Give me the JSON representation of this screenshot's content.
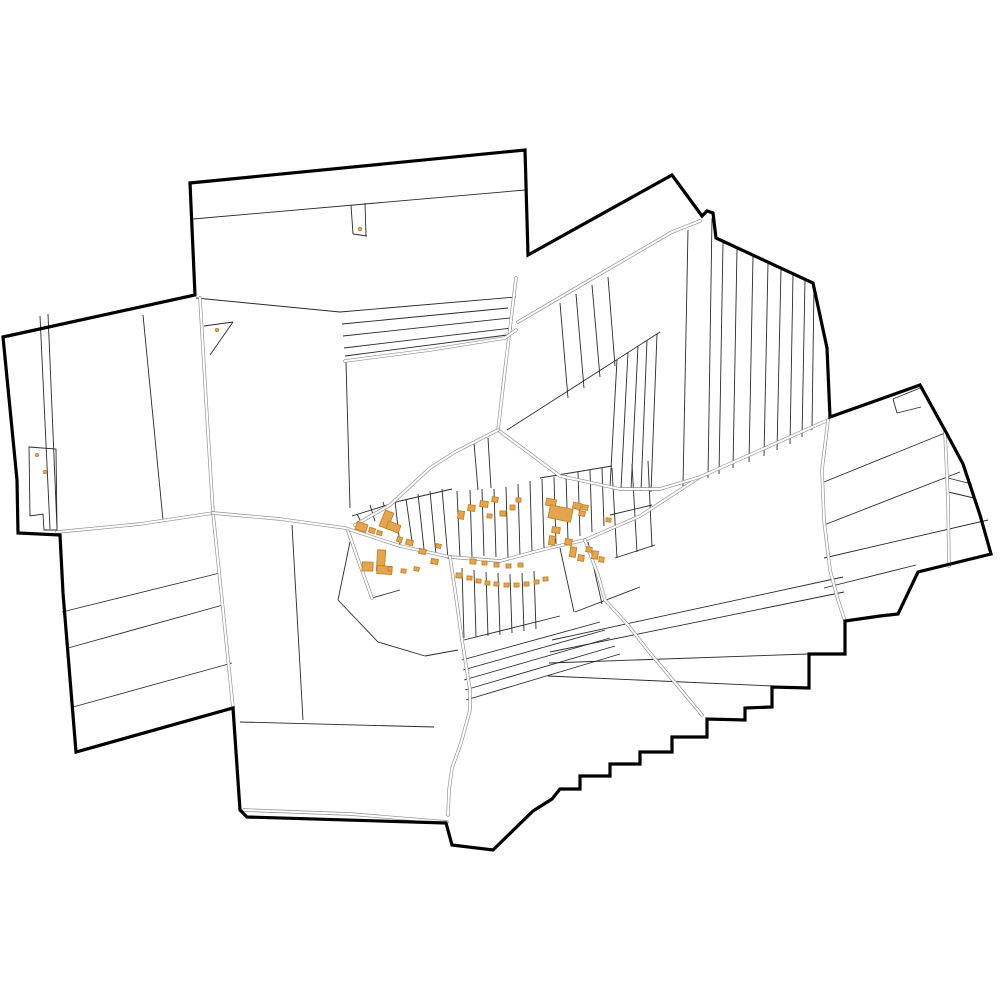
{
  "map": {
    "description": "cadastral-parcel-map-with-village",
    "background": "#ffffff",
    "colors": {
      "boundary": "#000000",
      "parcel_line": "#2a2a2a",
      "village_line": "#1f1f1f",
      "road_casing": "#8f8f8f",
      "road_fill": "#ffffff",
      "building_fill": "#e5a450",
      "building_stroke": "#c0832a",
      "dot_fill": "#dda35c",
      "dot_stroke": "#b07f35"
    },
    "stroke_widths": {
      "boundary": 3.2,
      "parcel": 0.9,
      "road_casing": 3.4,
      "road_fill": 2.1,
      "building": 0.9
    },
    "boundary_path": "M3 337 L195 295 L190 183 L525 150 L528 255 L672 175 L702 216 L707 211 L713 213 L716 238 L813 283 L827 348 L830 417 L920 385 L947 434 L963 464 L980 515 L991 554 L918 572 L898 614 L880 616 L845 621 L845 654 L809 654 L809 688 L772 687 L772 707 L745 708 L745 720 L707 719 L707 737 L672 737 L672 752 L640 752 L640 764 L610 764 L610 776 L580 776 L580 789 L560 789 L552 799 L533 811 L493 850 L452 845 L446 823 L247 817 L240 810 L233 708 L76 752 L63 593 L60 535 L18 533 L17 480 Z",
    "roads": [
      "M200 298 L206 400 L213 513",
      "M57 532 L140 524 L213 513",
      "M213 513 L222 600 L233 708",
      "M213 513 L280 519 L345 528 L400 546 L450 557 L500 561 L545 549 L585 540 L640 516 L700 477",
      "M498 430 L560 476 L620 489 L660 489 L700 477 L828 420",
      "M516 278 L505 370 L498 430",
      "M498 430 L455 452 L430 468 L390 505 L355 525",
      "M518 322 L600 274 L672 232 L700 221",
      "M345 361 L430 350 L505 338 L516 330",
      "M585 540 L598 575 L605 600 L628 625 L650 653 L677 685 L702 715",
      "M450 557 L455 590 L462 640 L470 690 L470 710 L461 743 L452 768 L449 790 L448 815",
      "M348 531 L360 565 L372 598",
      "M828 420 L822 470 L824 520 L830 570 L838 600 L845 621",
      "M945 432 L948 500 L949 566",
      "M244 810 L350 814 L447 822"
    ],
    "parcel_lines": [
      [
        193,
        219,
        525,
        190
      ],
      [
        351,
        205,
        353,
        234
      ],
      [
        353,
        234,
        367,
        236
      ],
      [
        366,
        236,
        365,
        203
      ],
      [
        196,
        298,
        340,
        312
      ],
      [
        340,
        312,
        516,
        297
      ],
      [
        342,
        324,
        508,
        308
      ],
      [
        343,
        336,
        510,
        318
      ],
      [
        344,
        348,
        512,
        328
      ],
      [
        345,
        356,
        507,
        335
      ],
      [
        40,
        316,
        50,
        529
      ],
      [
        48,
        314,
        57,
        528
      ],
      [
        143,
        315,
        163,
        520
      ],
      [
        204,
        326,
        233,
        322
      ],
      [
        233,
        322,
        210,
        355
      ],
      [
        346,
        362,
        350,
        508
      ],
      [
        292,
        525,
        303,
        720
      ],
      [
        240,
        722,
        434,
        727
      ],
      [
        62,
        612,
        220,
        573
      ],
      [
        68,
        648,
        223,
        605
      ],
      [
        73,
        707,
        232,
        663
      ],
      [
        507,
        430,
        660,
        332
      ],
      [
        560,
        303,
        568,
        398
      ],
      [
        576,
        294,
        584,
        388
      ],
      [
        592,
        285,
        600,
        377
      ],
      [
        608,
        277,
        615,
        366
      ],
      [
        617,
        360,
        610,
        487
      ],
      [
        628,
        352,
        621,
        489
      ],
      [
        638,
        346,
        631,
        490
      ],
      [
        647,
        340,
        641,
        491
      ],
      [
        657,
        334,
        651,
        492
      ],
      [
        688,
        230,
        683,
        486
      ],
      [
        712,
        218,
        708,
        478
      ],
      [
        723,
        243,
        719,
        474
      ],
      [
        737,
        249,
        733,
        468
      ],
      [
        753,
        256,
        749,
        462
      ],
      [
        768,
        263,
        764,
        456
      ],
      [
        781,
        269,
        777,
        450
      ],
      [
        793,
        275,
        790,
        444
      ],
      [
        805,
        280,
        802,
        437
      ],
      [
        814,
        285,
        812,
        430
      ],
      [
        552,
        640,
        843,
        577
      ],
      [
        550,
        652,
        844,
        592
      ],
      [
        549,
        663,
        808,
        654
      ],
      [
        548,
        676,
        772,
        686
      ],
      [
        462,
        660,
        600,
        622
      ],
      [
        463,
        670,
        605,
        630
      ],
      [
        464,
        680,
        610,
        638
      ],
      [
        465,
        690,
        615,
        646
      ],
      [
        466,
        700,
        620,
        654
      ],
      [
        824,
        525,
        960,
        472
      ],
      [
        824,
        558,
        988,
        520
      ],
      [
        824,
        588,
        916,
        565
      ],
      [
        824,
        482,
        945,
        433
      ],
      [
        948,
        478,
        972,
        484
      ],
      [
        948,
        492,
        974,
        498
      ],
      [
        893,
        399,
        920,
        388
      ],
      [
        897,
        413,
        921,
        407
      ],
      [
        893,
        399,
        897,
        413
      ],
      [
        474,
        443,
        478,
        490
      ],
      [
        488,
        438,
        491,
        488
      ],
      [
        352,
        516,
        400,
        501
      ],
      [
        400,
        501,
        452,
        489
      ],
      [
        540,
        478,
        612,
        466
      ],
      [
        362,
        524,
        357,
        514
      ],
      [
        375,
        521,
        370,
        505
      ],
      [
        388,
        519,
        383,
        502
      ],
      [
        400,
        545,
        395,
        501
      ],
      [
        412,
        541,
        406,
        499
      ],
      [
        424,
        549,
        418,
        494
      ],
      [
        436,
        555,
        430,
        491
      ],
      [
        448,
        559,
        442,
        489
      ],
      [
        460,
        558,
        457,
        491
      ],
      [
        472,
        557,
        470,
        490
      ],
      [
        484,
        556,
        482,
        489
      ],
      [
        496,
        557,
        494,
        489
      ],
      [
        508,
        558,
        506,
        487
      ],
      [
        520,
        556,
        518,
        484
      ],
      [
        532,
        552,
        530,
        481
      ],
      [
        544,
        548,
        542,
        479
      ],
      [
        556,
        544,
        554,
        477
      ],
      [
        568,
        540,
        566,
        475
      ],
      [
        580,
        536,
        578,
        472
      ],
      [
        592,
        532,
        590,
        470
      ],
      [
        604,
        526,
        602,
        468
      ],
      [
        612,
        468,
        617,
        558
      ],
      [
        632,
        464,
        637,
        552
      ],
      [
        648,
        461,
        652,
        547
      ],
      [
        610,
        515,
        652,
        505
      ],
      [
        615,
        558,
        655,
        545
      ],
      [
        462,
        568,
        464,
        638
      ],
      [
        474,
        570,
        476,
        637
      ],
      [
        486,
        572,
        488,
        636
      ],
      [
        498,
        573,
        500,
        635
      ],
      [
        510,
        574,
        512,
        633
      ],
      [
        522,
        573,
        524,
        631
      ],
      [
        534,
        571,
        536,
        629
      ],
      [
        464,
        640,
        560,
        616
      ],
      [
        560,
        548,
        574,
        612
      ],
      [
        588,
        542,
        602,
        604
      ],
      [
        575,
        612,
        640,
        587
      ],
      [
        350,
        542,
        338,
        600
      ],
      [
        338,
        600,
        378,
        642
      ],
      [
        378,
        642,
        425,
        656
      ],
      [
        425,
        656,
        458,
        650
      ],
      [
        372,
        598,
        400,
        590
      ]
    ],
    "parcel_paths": [
      "M29 447 L56 449 L57 530 L44 530 L43 514 L30 516 Z"
    ],
    "buildings": [
      [
        356,
        523,
        11,
        8,
        18
      ],
      [
        369,
        528,
        6,
        5,
        18
      ],
      [
        377,
        531,
        5,
        4,
        18
      ],
      [
        382,
        511,
        9,
        17,
        22
      ],
      [
        387,
        523,
        13,
        8,
        22
      ],
      [
        397,
        537,
        5,
        5,
        18
      ],
      [
        406,
        540,
        7,
        5,
        15
      ],
      [
        419,
        549,
        7,
        5,
        13
      ],
      [
        431,
        559,
        7,
        5,
        12
      ],
      [
        377,
        550,
        8,
        21,
        4
      ],
      [
        377,
        566,
        15,
        8,
        4
      ],
      [
        362,
        562,
        11,
        9,
        2
      ],
      [
        388,
        567,
        4,
        4,
        0
      ],
      [
        401,
        569,
        5,
        4,
        6
      ],
      [
        414,
        567,
        5,
        4,
        10
      ],
      [
        436,
        544,
        5,
        4,
        14
      ],
      [
        456,
        573,
        6,
        5,
        4
      ],
      [
        467,
        576,
        5,
        4,
        4
      ],
      [
        476,
        579,
        5,
        4,
        4
      ],
      [
        485,
        581,
        5,
        4,
        3
      ],
      [
        494,
        582,
        5,
        4,
        2
      ],
      [
        504,
        583,
        5,
        4,
        1
      ],
      [
        514,
        583,
        5,
        4,
        0
      ],
      [
        524,
        582,
        5,
        4,
        0
      ],
      [
        534,
        580,
        5,
        4,
        -2
      ],
      [
        543,
        577,
        5,
        4,
        -3
      ],
      [
        470,
        559,
        6,
        5,
        3
      ],
      [
        482,
        561,
        5,
        4,
        2
      ],
      [
        494,
        563,
        5,
        4,
        1
      ],
      [
        506,
        564,
        5,
        4,
        0
      ],
      [
        518,
        563,
        5,
        4,
        -1
      ],
      [
        458,
        511,
        6,
        8,
        8
      ],
      [
        468,
        505,
        7,
        6,
        8
      ],
      [
        480,
        501,
        8,
        6,
        8
      ],
      [
        492,
        497,
        6,
        5,
        8
      ],
      [
        487,
        514,
        5,
        4,
        4
      ],
      [
        500,
        511,
        6,
        5,
        2
      ],
      [
        510,
        505,
        5,
        5,
        0
      ],
      [
        516,
        498,
        5,
        4,
        0
      ],
      [
        546,
        499,
        10,
        7,
        12
      ],
      [
        549,
        507,
        23,
        13,
        12
      ],
      [
        573,
        503,
        8,
        6,
        12
      ],
      [
        579,
        511,
        6,
        5,
        12
      ],
      [
        552,
        527,
        8,
        6,
        8
      ],
      [
        549,
        536,
        6,
        9,
        8
      ],
      [
        582,
        505,
        6,
        5,
        10
      ],
      [
        565,
        539,
        7,
        6,
        8
      ],
      [
        570,
        547,
        6,
        10,
        8
      ],
      [
        578,
        555,
        6,
        6,
        8
      ],
      [
        586,
        547,
        6,
        5,
        8
      ],
      [
        592,
        551,
        6,
        8,
        8
      ],
      [
        599,
        557,
        5,
        5,
        8
      ],
      [
        606,
        518,
        5,
        4,
        5
      ]
    ],
    "dots": [
      [
        360,
        229
      ],
      [
        217,
        330
      ],
      [
        37,
        455
      ],
      [
        45,
        472
      ]
    ]
  }
}
